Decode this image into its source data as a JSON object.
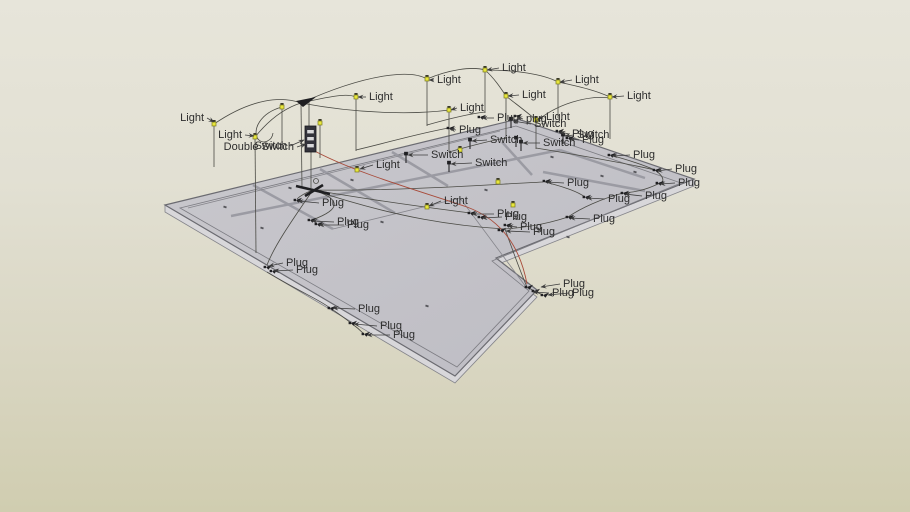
{
  "scene": {
    "app": "3d-model-viewport",
    "label_terms": {
      "light": "Light",
      "plug": "Plug",
      "switch": "Switch",
      "double_switch": "Double Switch"
    }
  },
  "colors": {
    "bg_top": "#e7e5da",
    "bg_bottom": "#d0cdb0",
    "floor_fill_a": "#c9c8cd",
    "floor_fill_b": "#bdbcc3",
    "floor_edge": "#6b6b71",
    "floor_band": "#d8d7da",
    "inner_line": "#7c7c82",
    "wall_thick": "#9b9ba3",
    "wall_thin": "#86868c",
    "wire": "#4a4a44",
    "wire_red": "#a84b3a",
    "leader": "#3c3c3c",
    "label_text": "#2d2d2d",
    "bulb_fill": "#e8e63c",
    "bulb_stroke": "#7a7a20",
    "bulb_cap": "#3a3a2a",
    "symbol_black": "#1f1f22",
    "panel_fill": "#33333b",
    "panel_slot": "#d8d8da",
    "dot": "#55555a"
  },
  "floor": {
    "outline": [
      [
        165,
        205
      ],
      [
        518,
        119
      ],
      [
        694,
        179
      ],
      [
        496,
        258
      ],
      [
        537,
        290
      ],
      [
        455,
        376
      ]
    ],
    "band": [
      [
        165,
        205
      ],
      [
        455,
        376
      ],
      [
        537,
        290
      ],
      [
        496,
        258
      ],
      [
        694,
        179
      ],
      [
        694,
        186
      ],
      [
        496,
        265
      ],
      [
        537,
        297
      ],
      [
        455,
        383
      ],
      [
        165,
        212
      ]
    ],
    "inner_ring": [
      [
        180,
        208
      ],
      [
        516,
        126
      ],
      [
        681,
        183
      ],
      [
        492,
        261
      ],
      [
        529,
        291
      ],
      [
        457,
        367
      ]
    ],
    "walls_thick": [
      [
        253,
        185,
        333,
        229
      ],
      [
        320,
        169,
        395,
        213
      ],
      [
        392,
        152,
        448,
        186
      ],
      [
        231,
        216,
        560,
        150
      ],
      [
        560,
        150,
        645,
        178
      ],
      [
        502,
        142,
        532,
        175
      ],
      [
        543,
        172,
        645,
        191
      ]
    ],
    "walls_thin": [
      [
        188,
        208,
        500,
        131
      ],
      [
        333,
        229,
        460,
        198
      ],
      [
        460,
        198,
        529,
        291
      ]
    ],
    "dots": [
      [
        225,
        207
      ],
      [
        262,
        228
      ],
      [
        290,
        188
      ],
      [
        352,
        180
      ],
      [
        382,
        222
      ],
      [
        427,
        306
      ],
      [
        486,
        190
      ],
      [
        552,
        157
      ],
      [
        602,
        176
      ],
      [
        568,
        237
      ],
      [
        635,
        172
      ]
    ]
  },
  "entities": {
    "lights": [
      [
        214,
        124
      ],
      [
        255,
        137
      ],
      [
        282,
        107
      ],
      [
        320,
        123
      ],
      [
        356,
        97
      ],
      [
        427,
        79
      ],
      [
        449,
        110
      ],
      [
        485,
        70
      ],
      [
        506,
        96
      ],
      [
        536,
        120
      ],
      [
        558,
        82
      ],
      [
        610,
        97
      ],
      [
        357,
        170
      ],
      [
        427,
        207
      ],
      [
        498,
        182
      ],
      [
        513,
        205
      ],
      [
        460,
        150
      ]
    ],
    "plugs": [
      [
        449,
        128
      ],
      [
        480,
        117
      ],
      [
        516,
        116
      ],
      [
        558,
        131
      ],
      [
        568,
        138
      ],
      [
        610,
        155
      ],
      [
        655,
        170
      ],
      [
        658,
        183
      ],
      [
        545,
        181
      ],
      [
        623,
        193
      ],
      [
        585,
        197
      ],
      [
        568,
        217
      ],
      [
        506,
        225
      ],
      [
        500,
        230
      ],
      [
        470,
        213
      ],
      [
        480,
        217
      ],
      [
        296,
        200
      ],
      [
        310,
        220
      ],
      [
        317,
        224
      ],
      [
        266,
        267
      ],
      [
        272,
        271
      ],
      [
        330,
        308
      ],
      [
        351,
        323
      ],
      [
        364,
        334
      ],
      [
        527,
        287
      ],
      [
        534,
        291
      ],
      [
        543,
        295
      ]
    ],
    "switches": [
      [
        406,
        155
      ],
      [
        449,
        164
      ],
      [
        470,
        141
      ],
      [
        511,
        120
      ],
      [
        516,
        139
      ],
      [
        521,
        143
      ],
      [
        563,
        136
      ]
    ],
    "verticals": [
      [
        214,
        124,
        214,
        167
      ],
      [
        255,
        137,
        256,
        253
      ],
      [
        282,
        107,
        282,
        148
      ],
      [
        320,
        123,
        320,
        158
      ],
      [
        356,
        97,
        356,
        151
      ],
      [
        427,
        79,
        427,
        126
      ],
      [
        449,
        110,
        449,
        152
      ],
      [
        485,
        70,
        485,
        113
      ],
      [
        506,
        96,
        506,
        139
      ],
      [
        536,
        120,
        536,
        149
      ],
      [
        558,
        82,
        558,
        118
      ],
      [
        610,
        97,
        610,
        139
      ],
      [
        301,
        103,
        302,
        188
      ],
      [
        309,
        100,
        309,
        126
      ],
      [
        311,
        151,
        311,
        188
      ]
    ],
    "panel": {
      "x": 305,
      "y": 126,
      "w": 11,
      "h": 26,
      "slots": 3
    },
    "hub_top": "296,101 316,97 303,107",
    "hub_floor_lines": [
      [
        296,
        186,
        330,
        194
      ],
      [
        305,
        196,
        323,
        185
      ]
    ],
    "junction_circle": [
      316,
      181,
      2.5
    ],
    "wires": [
      "M214,124 C252,98 282,96 301,103",
      "M255,137 C272,116 288,107 301,103",
      "M282,107 C260,113 252,130 258,139 C263,145 272,141 273,133",
      "M301,103 C340,94 349,94 356,97",
      "M301,103 C370,72 412,70 427,79",
      "M301,103 C365,115 420,114 449,110",
      "M427,79 C448,70 472,66 485,70",
      "M485,70 C494,78 500,87 506,96",
      "M485,70 C515,70 543,74 558,82",
      "M558,82 C582,87 597,91 610,97",
      "M506,96 C516,104 527,112 536,120",
      "M536,122 C556,104 588,95 610,98",
      "M313,190 C390,203 432,208 470,213",
      "M313,190 C400,219 458,226 504,229",
      "M313,190 C338,198 345,208 312,220",
      "M313,190 C305,193 300,196 297,199",
      "M313,190 C288,226 274,247 267,265",
      "M313,190 C400,191 482,185 543,182",
      "M267,272 C300,292 320,300 330,308",
      "M330,308 C342,316 346,319 351,323",
      "M351,323 C358,328 361,331 364,334",
      "M545,182 C568,188 578,192 585,197",
      "M610,155 C636,162 648,167 655,170",
      "M655,170 C666,178 664,183 658,184",
      "M658,184 C643,191 634,192 623,193",
      "M623,193 C601,199 581,208 568,217",
      "M568,217 C541,226 517,228 505,229",
      "M505,229 C514,254 520,271 527,287",
      "M527,287 C532,290 538,293 543,295",
      "M536,148 C596,158 634,165 655,170",
      "M449,152 C470,146 488,141 506,138",
      "M427,125 C448,119 468,114 485,112",
      "M356,150 C390,142 420,133 449,128"
    ],
    "wire_red": "M311,149 C352,172 420,191 467,207 C505,221 521,252 527,284"
  },
  "labels": {
    "light": [
      {
        "text": "Light",
        "lx": 207,
        "ly": 118,
        "tx": 214,
        "ty": 122
      },
      {
        "text": "Light",
        "lx": 245,
        "ly": 135,
        "tx": 254,
        "ty": 136
      },
      {
        "text": "Light",
        "lx": 366,
        "ly": 97,
        "tx": 358,
        "ty": 97
      },
      {
        "text": "Light",
        "lx": 434,
        "ly": 80,
        "tx": 429,
        "ty": 80
      },
      {
        "text": "Light",
        "lx": 457,
        "ly": 108,
        "tx": 451,
        "ty": 110
      },
      {
        "text": "Light",
        "lx": 499,
        "ly": 68,
        "tx": 487,
        "ty": 70
      },
      {
        "text": "Light",
        "lx": 519,
        "ly": 95,
        "tx": 508,
        "ty": 96
      },
      {
        "text": "Light",
        "lx": 543,
        "ly": 117,
        "tx": 538,
        "ty": 119
      },
      {
        "text": "Light",
        "lx": 572,
        "ly": 80,
        "tx": 560,
        "ty": 82
      },
      {
        "text": "Light",
        "lx": 624,
        "ly": 96,
        "tx": 612,
        "ty": 97
      },
      {
        "text": "Light",
        "lx": 373,
        "ly": 165,
        "tx": 360,
        "ty": 169
      },
      {
        "text": "Light",
        "lx": 441,
        "ly": 201,
        "tx": 429,
        "ty": 206
      }
    ],
    "plug": [
      {
        "text": "Plug",
        "lx": 456,
        "ly": 130,
        "tx": 450,
        "ty": 129
      },
      {
        "text": "Plug",
        "lx": 494,
        "ly": 118,
        "tx": 482,
        "ty": 118
      },
      {
        "text": "plug",
        "lx": 523,
        "ly": 119,
        "tx": 517,
        "ty": 117
      },
      {
        "text": "Plug",
        "lx": 569,
        "ly": 134,
        "tx": 560,
        "ty": 132
      },
      {
        "text": "Plug",
        "lx": 579,
        "ly": 140,
        "tx": 570,
        "ty": 139
      },
      {
        "text": "Plug",
        "lx": 630,
        "ly": 155,
        "tx": 612,
        "ty": 156
      },
      {
        "text": "Plug",
        "lx": 672,
        "ly": 169,
        "tx": 657,
        "ty": 171
      },
      {
        "text": "Plug",
        "lx": 675,
        "ly": 183,
        "tx": 660,
        "ty": 184
      },
      {
        "text": "Plug",
        "lx": 564,
        "ly": 183,
        "tx": 547,
        "ty": 182
      },
      {
        "text": "Plug",
        "lx": 642,
        "ly": 196,
        "tx": 625,
        "ty": 194
      },
      {
        "text": "Plug",
        "lx": 605,
        "ly": 199,
        "tx": 587,
        "ty": 198
      },
      {
        "text": "Plug",
        "lx": 590,
        "ly": 219,
        "tx": 570,
        "ty": 218
      },
      {
        "text": "Plug",
        "lx": 517,
        "ly": 227,
        "tx": 508,
        "ty": 226
      },
      {
        "text": "Plug",
        "lx": 530,
        "ly": 232,
        "tx": 506,
        "ty": 231
      },
      {
        "text": "Plug",
        "lx": 494,
        "ly": 214,
        "tx": 472,
        "ty": 214
      },
      {
        "text": "Plug",
        "lx": 502,
        "ly": 217,
        "tx": 482,
        "ty": 218
      },
      {
        "text": "Plug",
        "lx": 319,
        "ly": 203,
        "tx": 298,
        "ty": 201
      },
      {
        "text": "Plug",
        "lx": 334,
        "ly": 222,
        "tx": 312,
        "ty": 221
      },
      {
        "text": "Plug",
        "lx": 344,
        "ly": 225,
        "tx": 319,
        "ty": 225
      },
      {
        "text": "Plug",
        "lx": 283,
        "ly": 263,
        "tx": 269,
        "ty": 266
      },
      {
        "text": "Plug",
        "lx": 293,
        "ly": 270,
        "tx": 274,
        "ty": 271
      },
      {
        "text": "Plug",
        "lx": 355,
        "ly": 309,
        "tx": 333,
        "ty": 308
      },
      {
        "text": "Plug",
        "lx": 377,
        "ly": 326,
        "tx": 354,
        "ty": 324
      },
      {
        "text": "Plug",
        "lx": 390,
        "ly": 335,
        "tx": 367,
        "ty": 335
      },
      {
        "text": "Plug",
        "lx": 560,
        "ly": 284,
        "tx": 541,
        "ty": 287
      },
      {
        "text": "Plug",
        "lx": 549,
        "ly": 293,
        "tx": 533,
        "ty": 292
      },
      {
        "text": "Plug",
        "lx": 569,
        "ly": 293,
        "tx": 548,
        "ty": 295
      }
    ],
    "switch": [
      {
        "text": "Switch",
        "lx": 428,
        "ly": 155,
        "tx": 408,
        "ty": 155
      },
      {
        "text": "Switch",
        "lx": 472,
        "ly": 163,
        "tx": 451,
        "ty": 164
      },
      {
        "text": "Switch",
        "lx": 487,
        "ly": 140,
        "tx": 472,
        "ty": 141
      },
      {
        "text": "Switch",
        "lx": 531,
        "ly": 124,
        "tx": 513,
        "ty": 121
      },
      {
        "text": "Switch",
        "lx": 540,
        "ly": 143,
        "tx": 523,
        "ty": 143
      },
      {
        "text": "Switch",
        "lx": 574,
        "ly": 135,
        "tx": 565,
        "ty": 136
      },
      {
        "text": "Switch",
        "lx": 290,
        "ly": 146,
        "tx": 304,
        "ty": 140
      }
    ],
    "double_switch": [
      {
        "text": "Double Switch",
        "lx": 297,
        "ly": 147,
        "tx": 306,
        "ty": 144
      }
    ]
  }
}
